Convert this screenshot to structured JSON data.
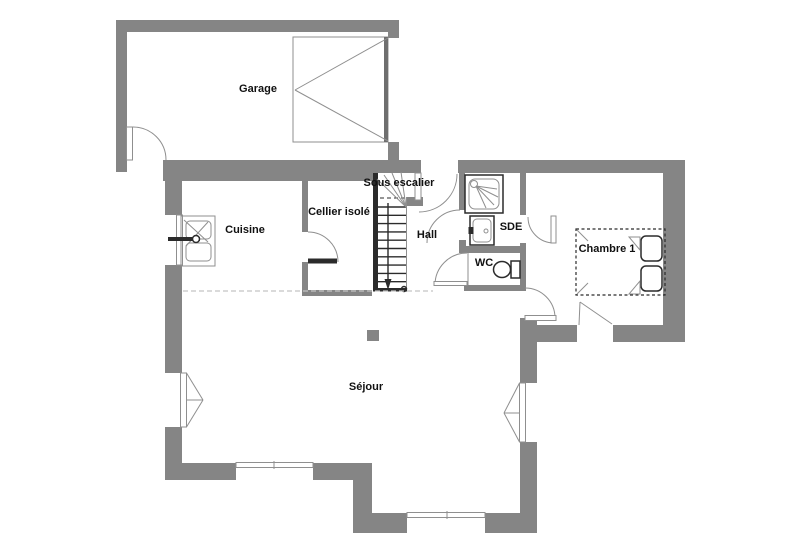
{
  "plan": {
    "type": "floor-plan",
    "background": "#ffffff"
  },
  "colors": {
    "wall": "#858585",
    "dark": "#2b2b2b",
    "line": "#8f8f8f",
    "dash": "#c4c4c4",
    "text": "#111111"
  },
  "rooms": {
    "garage": {
      "label": "Garage"
    },
    "cuisine": {
      "label": "Cuisine"
    },
    "cellier": {
      "label": "Cellier isolé"
    },
    "sous_escalier": {
      "label": "Sous escalier"
    },
    "hall": {
      "label": "Hall"
    },
    "sde": {
      "label": "SDE"
    },
    "wc": {
      "label": "WC"
    },
    "chambre1": {
      "label": "Chambre 1"
    },
    "sejour": {
      "label": "Séjour"
    }
  }
}
